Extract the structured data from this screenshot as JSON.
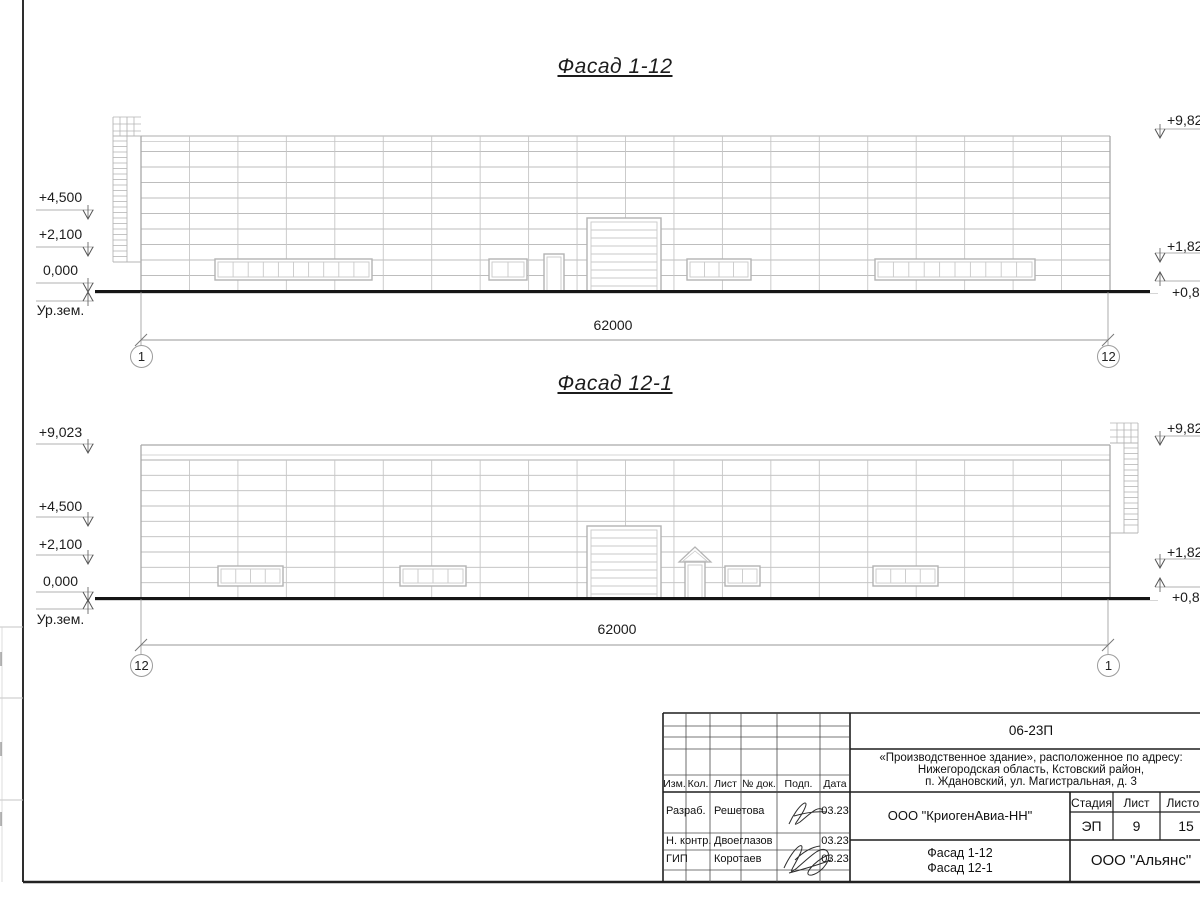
{
  "page": {
    "facade1": {
      "title": "Фасад 1-12",
      "dim": "62000",
      "axis_left": "1",
      "axis_right": "12",
      "marks_left": {
        "m1": "+4,500",
        "m2": "+2,100",
        "m3": "0,000",
        "m4": "Ур.зем."
      },
      "marks_right": {
        "m1": "+9,82",
        "m2": "+1,82",
        "m3": "+0,82"
      }
    },
    "facade2": {
      "title": "Фасад 12-1",
      "dim": "62000",
      "axis_left": "12",
      "axis_right": "1",
      "marks_left": {
        "m0": "+9,023",
        "m1": "+4,500",
        "m2": "+2,100",
        "m3": "0,000",
        "m4": "Ур.зем."
      },
      "marks_right": {
        "m1": "+9,82",
        "m2": "+1,82",
        "m3": "+0,82"
      }
    },
    "titleblock": {
      "code": "06-23П",
      "address1": "«Производственное здание», расположенное по адресу:",
      "address2": "Нижегородская область, Кстовский район,",
      "address3": "п. Ждановский, ул. Магистральная, д. 3",
      "h_izm": "Изм.",
      "h_kol": "Кол.",
      "h_list": "Лист",
      "h_ndok": "№ док.",
      "h_podp": "Подп.",
      "h_data": "Дата",
      "r1_role": "Разраб.",
      "r1_name": "Решетова",
      "r1_date": "03.23",
      "r2_role": "Н. контр.",
      "r2_name": "Двоеглазов",
      "r2_date": "03.23",
      "r3_role": "ГИП",
      "r3_name": "Коротаев",
      "r3_date": "03.23",
      "company": "ООО \"КриогенАвиа-НН\"",
      "h_stage": "Стадия",
      "h_sheet": "Лист",
      "h_sheets": "Листов",
      "stage": "ЭП",
      "sheet": "9",
      "sheets": "15",
      "content1": "Фасад 1-12",
      "content2": "Фасад 12-1",
      "org": "ООО \"Альянс\""
    }
  }
}
